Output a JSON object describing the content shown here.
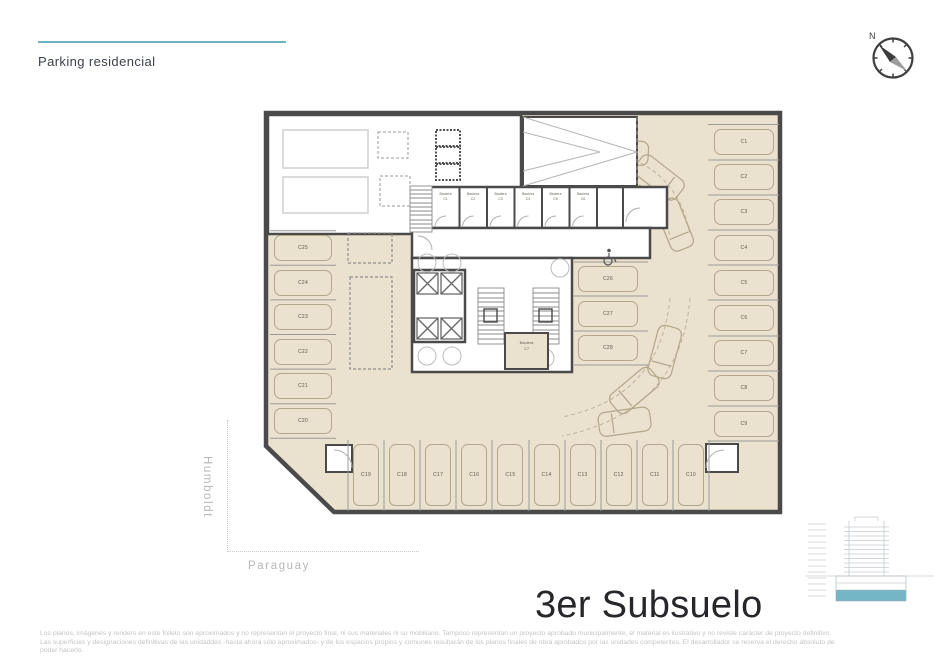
{
  "header": {
    "title": "Parking residencial"
  },
  "compass": {
    "north_label": "N"
  },
  "plan": {
    "spots_left": [
      "C25",
      "C24",
      "C23",
      "C22",
      "C21",
      "C20"
    ],
    "spots_right": [
      "C1",
      "C2",
      "C3",
      "C4",
      "C5",
      "C6",
      "C7",
      "C8",
      "C9"
    ],
    "spots_middle": [
      "C26",
      "C27",
      "C28"
    ],
    "spots_bottom": [
      "C19",
      "C18",
      "C17",
      "C16",
      "C15",
      "C14",
      "C13",
      "C12",
      "C11",
      "C10"
    ],
    "bauleras": [
      {
        "name": "Baulera",
        "code": "C1"
      },
      {
        "name": "Baulera",
        "code": "C2"
      },
      {
        "name": "Baulera",
        "code": "C3"
      },
      {
        "name": "Baulera",
        "code": "C4"
      },
      {
        "name": "Baulera",
        "code": "C5"
      },
      {
        "name": "Baulera",
        "code": "C6"
      }
    ],
    "baulera_c7": {
      "name": "Baulera",
      "code": "C7"
    },
    "accessible_spot": "C26"
  },
  "streets": {
    "vertical": "Humboldt",
    "horizontal": "Paraguay"
  },
  "level": {
    "title": "3er Subsuelo"
  },
  "disclaimer": {
    "line1": "Los planos, imágenes y renders en este folleto son aproximados y no representan el proyecto final, ni sus materiales ni su mobiliario. Tampoco representan un proyecto aprobado municipalmente, el material es ilustrativo y no reviste carácter de proyecto definitivo.",
    "line2": "Las superficies y designaciones definitivas de las unidaddes -hasta ahora sólo aproximados- y de los espacios propios y comunes resultarán de los planos finales de obra aprobados por las unidades competentes. El desarrollador se reserva el derecho absoluto de",
    "line3": "poder hacerlo."
  },
  "colors": {
    "accent_teal": "#6fb2c3",
    "plan_fill": "#eae1ce",
    "wall": "#4a4a4a",
    "section_highlight": "#74b6c5"
  }
}
